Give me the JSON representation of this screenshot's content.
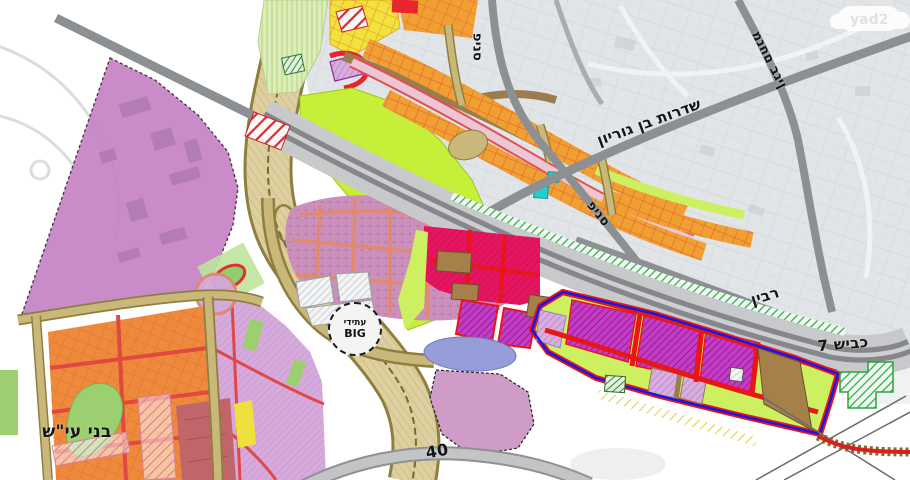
{
  "map": {
    "watermark": "yad2",
    "labels": {
      "pines_top": "פינס",
      "pines_diag": "פינס",
      "ben_gurion": "שדרות בן גוריון",
      "menachem_begin": "מנחם בגין",
      "rabin": "רבין",
      "road7": "כביש 7",
      "road40": "40",
      "bnei_ayish": "בני עי\"ש"
    },
    "big": {
      "line1": "עתידי",
      "line2": "BIG"
    },
    "colors": {
      "purple_zone": "#c584c5",
      "residential_pink": "#ca8fba",
      "commercial_magenta": "#c63bc6",
      "crimson_zone": "#e5155f",
      "chartreuse": "#c6ef3a",
      "orange_parcels": "#f0a032",
      "corridor_tan": "#decfa0",
      "road_gray": "#8d9093",
      "highway_band": "#c7c9ca",
      "boundary_blue": "#1717e8",
      "road_red": "#e81717",
      "green_strip": "#2fae46",
      "periwinkle": "#979dd9",
      "bnei_ayish_orange": "#ee8a3c"
    }
  }
}
